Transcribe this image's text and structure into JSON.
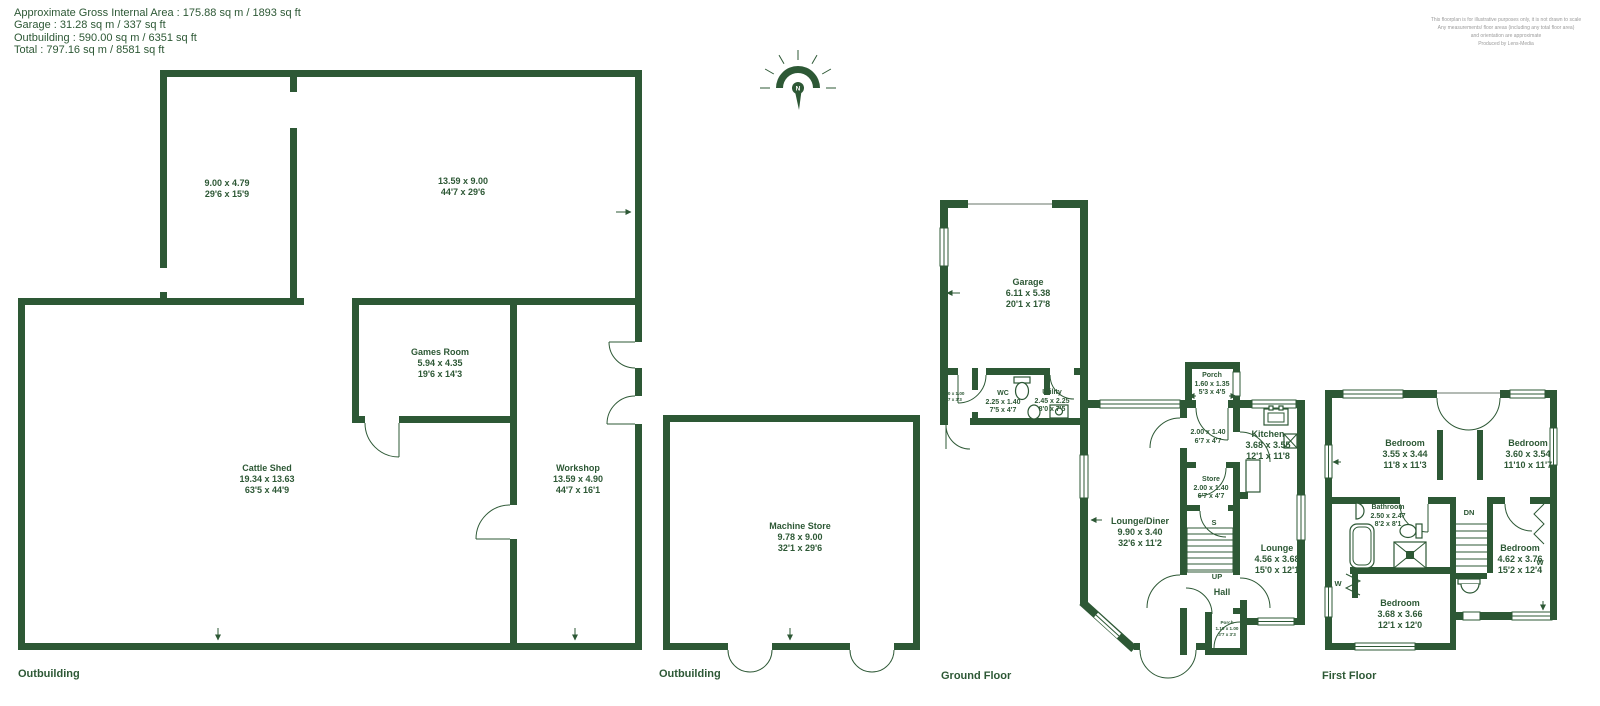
{
  "header": {
    "summary": [
      "Approximate Gross Internal Area : 175.88 sq m / 1893 sq ft",
      "Garage : 31.28 sq m / 337 sq ft",
      "Outbuilding : 590.00 sq m / 6351 sq ft",
      "Total : 797.16 sq m / 8581 sq ft"
    ],
    "disclaimer": [
      "This floorplan is for illustrative purposes only, it is not drawn to scale",
      "Any measurements/ floor areas (including any total floor area)",
      "and orientation are approximate",
      "Produced by Lens-Media"
    ]
  },
  "compass": {
    "n": "N"
  },
  "colors": {
    "wall": "#2d5835",
    "text": "#2d5835",
    "disclaimer": "#9b9b9b",
    "background": "#ffffff"
  },
  "sections": {
    "out1": "Outbuilding",
    "out2": "Outbuilding",
    "ground": "Ground Floor",
    "first": "First Floor"
  },
  "rooms": {
    "out1_room1": {
      "metric": "9.00 x 4.79",
      "imperial": "29'6 x 15'9"
    },
    "out1_room2": {
      "metric": "13.59 x 9.00",
      "imperial": "44'7 x 29'6"
    },
    "games_room": {
      "name": "Games Room",
      "metric": "5.94 x 4.35",
      "imperial": "19'6 x 14'3"
    },
    "cattle_shed": {
      "name": "Cattle Shed",
      "metric": "19.34 x 13.63",
      "imperial": "63'5 x 44'9"
    },
    "workshop": {
      "name": "Workshop",
      "metric": "13.59 x 4.90",
      "imperial": "44'7 x 16'1"
    },
    "machine_store": {
      "name": "Machine Store",
      "metric": "9.78 x 9.00",
      "imperial": "32'1 x 29'6"
    },
    "garage": {
      "name": "Garage",
      "metric": "6.11 x 5.38",
      "imperial": "20'1 x 17'8"
    },
    "side_lobby": {
      "metric": "2.00 x 1.00",
      "imperial": "6'7 x 3'3"
    },
    "wc": {
      "name": "WC",
      "metric": "2.25 x 1.40",
      "imperial": "7'5 x 4'7"
    },
    "utility": {
      "name": "Utility",
      "metric": "2.45 x 2.25",
      "imperial": "8'0 x 7'5"
    },
    "porch_front": {
      "name": "Porch",
      "metric": "1.60 x 1.35",
      "imperial": "5'3 x 4'5"
    },
    "entrance_lobby": {
      "metric": "2.00 x 1.40",
      "imperial": "6'7 x 4'7"
    },
    "kitchen": {
      "name": "Kitchen",
      "metric": "3.68 x 3.55",
      "imperial": "12'1 x 11'8"
    },
    "store": {
      "name": "Store",
      "metric": "2.00 x 1.40",
      "imperial": "6'7 x 4'7"
    },
    "cupboard": {
      "name": "S"
    },
    "lounge_diner": {
      "name": "Lounge/Diner",
      "metric": "9.90 x 3.40",
      "imperial": "32'6 x 11'2"
    },
    "lounge": {
      "name": "Lounge",
      "metric": "4.56 x 3.68",
      "imperial": "15'0 x 12'1"
    },
    "stairs_up": {
      "name": "UP"
    },
    "hall": {
      "name": "Hall"
    },
    "porch_rear": {
      "name": "Porch",
      "metric": "1.10 x 1.00",
      "imperial": "3'7 x 3'3"
    },
    "bedroom1": {
      "name": "Bedroom",
      "metric": "3.55 x 3.44",
      "imperial": "11'8 x 11'3"
    },
    "bedroom2": {
      "name": "Bedroom",
      "metric": "3.60 x 3.54",
      "imperial": "11'10 x 11'7"
    },
    "bathroom": {
      "name": "Bathroom",
      "metric": "2.50 x 2.47",
      "imperial": "8'2 x 8'1"
    },
    "stairs_dn": {
      "name": "DN"
    },
    "bedroom3": {
      "name": "Bedroom",
      "metric": "4.62 x 3.76",
      "imperial": "15'2 x 12'4"
    },
    "bedroom4": {
      "name": "Bedroom",
      "metric": "3.68 x 3.66",
      "imperial": "12'1 x 12'0"
    },
    "wardrobe_left": {
      "name": "W"
    },
    "wardrobe_right": {
      "name": "W"
    }
  }
}
